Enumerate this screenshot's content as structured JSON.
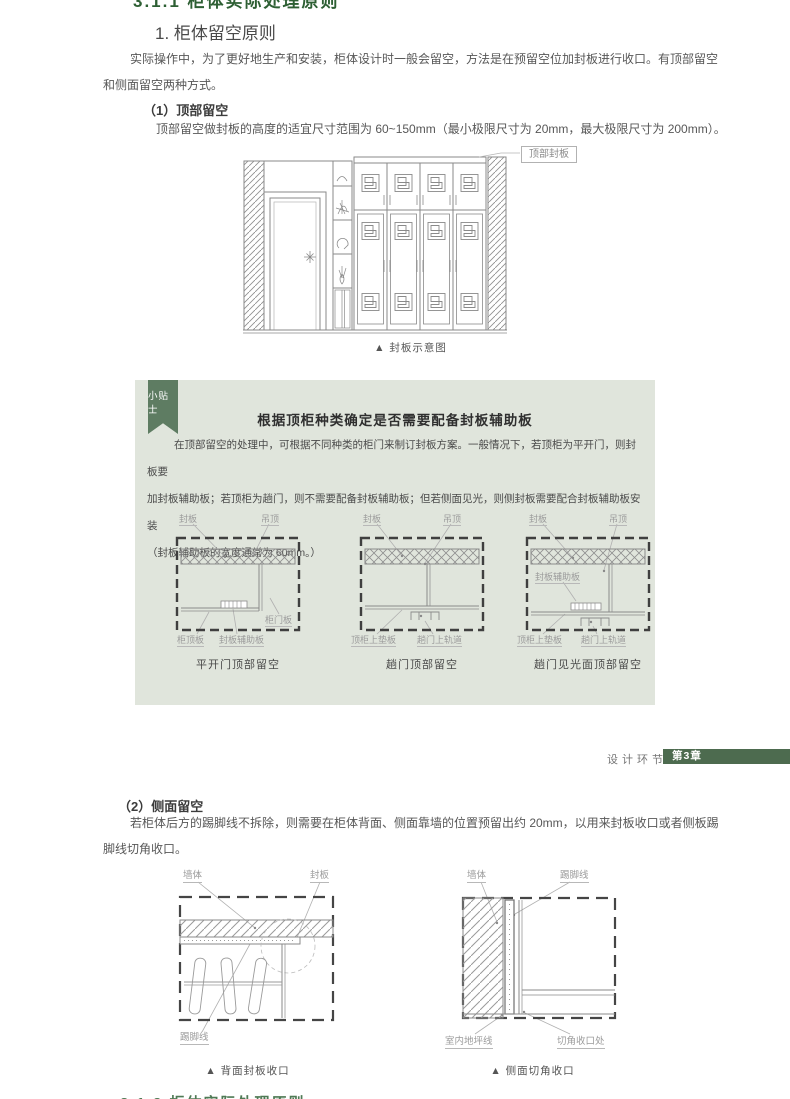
{
  "top_heading": "3.1.1 柜体实际处理原则",
  "section": {
    "title": "1. 柜体留空原则",
    "intro_lines": [
      "实际操作中，为了更好地生产和安装，柜体设计时一般会留空，方法是在预留空位加封板进行收口。有顶部留空",
      "和侧面留空两种方式。"
    ]
  },
  "sub1": {
    "heading": "（1）顶部留空",
    "body": "顶部留空做封板的高度的适宜尺寸范围为 60~150mm（最小极限尺寸为 20mm，最大极限尺寸为 200mm）。"
  },
  "fig_seal": {
    "label": "顶部封板",
    "caption": "▲ 封板示意图"
  },
  "tip": {
    "ribbon": "小贴士",
    "title": "根据顶柜种类确定是否需要配备封板辅助板",
    "body_lines": [
      "在顶部留空的处理中，可根据不同种类的柜门来制订封板方案。一般情况下，若顶柜为平开门，则封板要",
      "加封板辅助板；若顶柜为趟门，则不需要配备封板辅助板；但若侧面见光，则侧封板需要配合封板辅助板安装",
      "（封板辅助板的宽度通常为 60mm。）"
    ],
    "bg_color": "#e0e5dc",
    "ribbon_color": "#5e7c62",
    "diagrams": [
      {
        "caption": "平开门顶部留空",
        "labels": {
          "seal": "封板",
          "ceiling": "吊顶",
          "door": "柜门板",
          "top": "柜顶板",
          "aux": "封板辅助板"
        }
      },
      {
        "caption": "趟门顶部留空",
        "labels": {
          "seal": "封板",
          "ceiling": "吊顶",
          "pad": "顶柜上垫板",
          "track": "趟门上轨道"
        }
      },
      {
        "caption": "趟门见光面顶部留空",
        "labels": {
          "seal": "封板",
          "ceiling": "吊顶",
          "aux": "封板辅助板",
          "pad": "顶柜上垫板",
          "track": "趟门上轨道"
        }
      }
    ]
  },
  "footer": {
    "section_label": "设计环节",
    "chapter_badge": "第3章",
    "badge_color": "#4d6b4f"
  },
  "sub2": {
    "heading": "（2）侧面留空",
    "body_lines": [
      "若柜体后方的踢脚线不拆除，则需要在柜体背面、侧面靠墙的位置预留出约 20mm，以用来封板收口或者侧板踢",
      "脚线切角收口。"
    ]
  },
  "fig_back": {
    "caption": "▲ 背面封板收口",
    "labels": {
      "wall": "墙体",
      "seal": "封板",
      "skirting": "踢脚线"
    }
  },
  "fig_side": {
    "caption": "▲ 侧面切角收口",
    "labels": {
      "wall": "墙体",
      "skirting": "踢脚线",
      "floor": "室内地坪线",
      "corner": "切角收口处"
    }
  },
  "next_heading": "3.1.2 柜体实际处理原则",
  "accent_green": "#2d5f33"
}
